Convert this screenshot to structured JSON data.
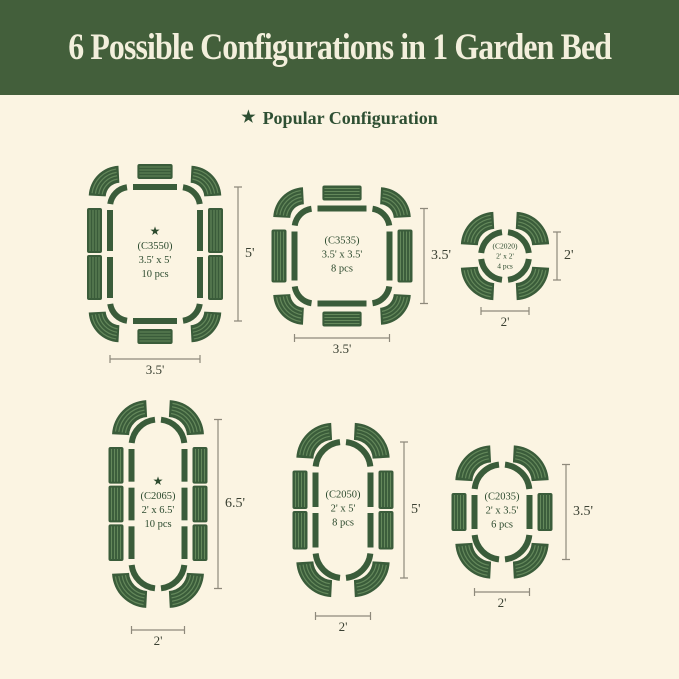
{
  "header": {
    "title": "6 Possible Configurations in 1 Garden Bed"
  },
  "legend": {
    "label": "Popular Configuration"
  },
  "icons": {
    "star": "★"
  },
  "colors": {
    "background": "#fbf4e2",
    "header_bg": "#435f3b",
    "header_text": "#f3efdc",
    "bed_green": "#3a5c3a",
    "stripe_green": "#64885b",
    "text_green": "#2c4a2e",
    "dim_line": "#8e897b",
    "dim_text": "#3a4032"
  },
  "configs": [
    {
      "code": "(C3550)",
      "size": "3.5' x 5'",
      "pieces": "10 pcs",
      "popular": true,
      "width_ft": 3.5,
      "height_ft": 5,
      "pieces_count": 10,
      "shape": "rounded-rectangle",
      "width_label": "3.5'",
      "height_label": "5'"
    },
    {
      "code": "(C3535)",
      "size": "3.5' x 3.5'",
      "pieces": "8 pcs",
      "popular": false,
      "width_ft": 3.5,
      "height_ft": 3.5,
      "pieces_count": 8,
      "shape": "rounded-square",
      "width_label": "3.5'",
      "height_label": "3.5'"
    },
    {
      "code": "(C2020)",
      "size": "2' x 2'",
      "pieces": "4 pcs",
      "popular": false,
      "width_ft": 2,
      "height_ft": 2,
      "pieces_count": 4,
      "shape": "circle",
      "width_label": "2'",
      "height_label": "2'"
    },
    {
      "code": "(C2065)",
      "size": "2' x 6.5'",
      "pieces": "10 pcs",
      "popular": true,
      "width_ft": 2,
      "height_ft": 6.5,
      "pieces_count": 10,
      "shape": "capsule",
      "width_label": "2'",
      "height_label": "6.5'"
    },
    {
      "code": "(C2050)",
      "size": "2' x 5'",
      "pieces": "8 pcs",
      "popular": false,
      "width_ft": 2,
      "height_ft": 5,
      "pieces_count": 8,
      "shape": "capsule",
      "width_label": "2'",
      "height_label": "5'"
    },
    {
      "code": "(C2035)",
      "size": "2' x 3.5'",
      "pieces": "6 pcs",
      "popular": false,
      "width_ft": 2,
      "height_ft": 3.5,
      "pieces_count": 6,
      "shape": "capsule",
      "width_label": "2'",
      "height_label": "3.5'"
    }
  ]
}
